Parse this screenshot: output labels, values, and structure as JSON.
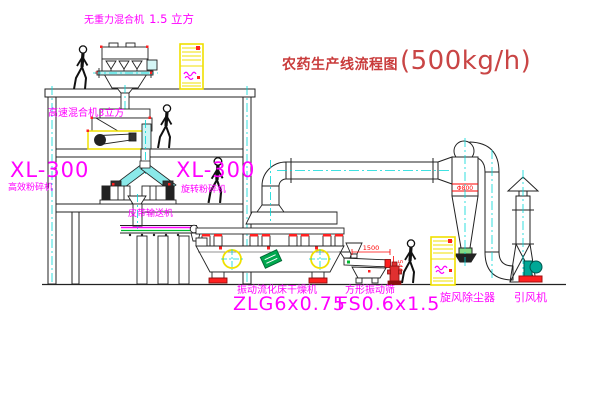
{
  "title": {
    "name": "农药生产线流程图",
    "capacity": "(500kg/h)"
  },
  "labels": {
    "gravity_mixer_name": "无重力混合机",
    "gravity_mixer_size": "1.5 立方",
    "speed_mixer": "高速混合机3立方",
    "crusher_left_model": "XL-300",
    "crusher_left_name": "高效粉碎机",
    "crusher_mid_model": "XL-300",
    "crusher_mid_name": "旋转粉碎机",
    "belt_conveyor": "皮带输送机",
    "dryer_name": "振动流化床干燥机",
    "dryer_model": "ZLG6x0.75",
    "sieve_name": "方形振动筛",
    "sieve_model": "FS0.6x1.5",
    "cyclone": "旋风除尘器",
    "fan": "引风机"
  },
  "dimensions": {
    "cyclone_diameter": "Φ800",
    "sieve_length": "1500",
    "sieve_height": "540"
  },
  "colors": {
    "label_magenta": "#ff00ff",
    "title_red": "#c93b3b",
    "dimension_red": "#ff0000",
    "centerline_cyan": "#00d8d8",
    "accent_yellow": "#f0e000",
    "accent_red": "#ff2020",
    "fan_teal": "#00a896",
    "sticker_green": "#00a84f"
  }
}
